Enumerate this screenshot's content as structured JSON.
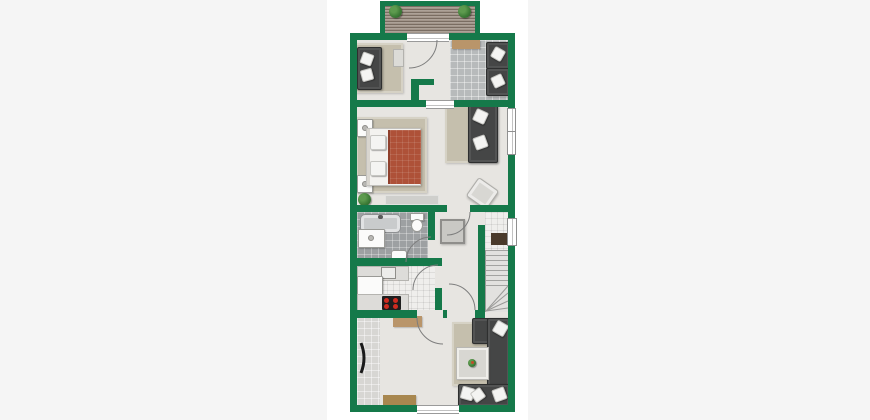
{
  "image": {
    "type": "floor-plan",
    "description": "Top-down 2D architectural floor plan of a narrow upper apartment storey with green walls on a white sheet, centered on a light gray page. No text labels are rendered.",
    "width": 870,
    "height": 420
  },
  "palette": {
    "pageBg": "#f5f5f5",
    "canvasBg": "#ffffff",
    "wall": "#15794a",
    "floor": "#e7e5e1",
    "tileGray": "#b7babb",
    "tileDark": "#9da0a2",
    "tileWhite": "#efeeec",
    "tileStrip": "#d7d6d3",
    "rug": "#c5bfad",
    "rugGray": "#cfcfcc",
    "sofa": "#454646",
    "pillow": "#f4f4f2",
    "blanket": "#ae5138",
    "wood": "#a2958a",
    "matTan": "#b9956a",
    "matTanDark": "#a8874f",
    "doormat": "#4a3a2b",
    "chairLight": "#d8d7d3",
    "tableGray": "#c9c8c4",
    "counter": "#dddcd9",
    "tub": "#c9cbcc",
    "stove": "#1e1e1e",
    "burner": "#cf2b20",
    "plant": "#3c7a36",
    "stairTread": "#e2e1df",
    "line": "#7d7d7d"
  },
  "rooms": [
    {
      "name": "balcony",
      "features": [
        "wood-plank-deck",
        "two-corner-plants",
        "green-parapet"
      ]
    },
    {
      "name": "upper-lounge",
      "features": [
        "dark-sofa",
        "two-white-pillows",
        "beige-rug",
        "side-table"
      ]
    },
    {
      "name": "upper-hall",
      "features": [
        "balcony-door",
        "threshold-to-bedroom"
      ]
    },
    {
      "name": "office-room",
      "features": [
        "gray-tile-floor",
        "tan-mat",
        "two-dark-armchairs"
      ]
    },
    {
      "name": "bedroom",
      "features": [
        "double-bed-terracotta-blanket",
        "two-nightstands",
        "beige-rug",
        "gray-rug",
        "potted-plant",
        "dark-sofa",
        "light-armchair",
        "two-right-wall-windows"
      ]
    },
    {
      "name": "bathroom",
      "features": [
        "bathtub",
        "vanity",
        "toilet",
        "sink",
        "dark-tile-floor",
        "door"
      ]
    },
    {
      "name": "kitchen",
      "features": [
        "white-tile-floor",
        "counters",
        "sink",
        "stove-four-burners",
        "fridge",
        "door"
      ]
    },
    {
      "name": "hallway",
      "features": [
        "square-table",
        "three-doors"
      ]
    },
    {
      "name": "entry-landing",
      "features": [
        "front-door",
        "dark-doormat",
        "white-tile-floor"
      ]
    },
    {
      "name": "staircase",
      "features": [
        "straight-run",
        "winder-bottom"
      ]
    },
    {
      "name": "living-room",
      "features": [
        "u-shaped-dark-sectional",
        "white-pillows",
        "beige-rug",
        "coffee-table-with-plant",
        "tv-on-left-wall",
        "two-tan-mats",
        "tile-strip",
        "bottom-window"
      ]
    }
  ],
  "furniture_counts": {
    "sofas": 3,
    "armchairs": 3,
    "beds": 1,
    "tables": 3,
    "plants": 4,
    "windows": 3,
    "doors": 7
  }
}
